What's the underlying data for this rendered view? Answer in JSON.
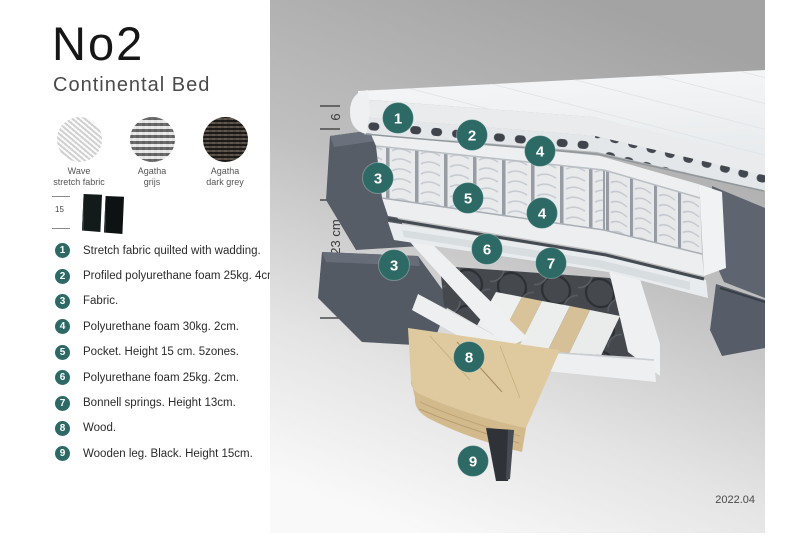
{
  "header": {
    "title": "No2",
    "subtitle": "Continental Bed"
  },
  "swatches": [
    {
      "line1": "Wave",
      "line2": "stretch fabric"
    },
    {
      "line1": "Agatha",
      "line2": "grijs"
    },
    {
      "line1": "Agatha",
      "line2": "dark grey"
    }
  ],
  "thumb": {
    "label": "15"
  },
  "legend": {
    "items": [
      {
        "num": "1",
        "text": "Stretch fabric quilted with wadding."
      },
      {
        "num": "2",
        "text": "Profiled polyurethane foam 25kg. 4cm."
      },
      {
        "num": "3",
        "text": "Fabric."
      },
      {
        "num": "4",
        "text": "Polyurethane foam 30kg. 2cm."
      },
      {
        "num": "5",
        "text": "Pocket. Height 15 cm. 5zones."
      },
      {
        "num": "6",
        "text": "Polyurethane foam 25kg. 2cm."
      },
      {
        "num": "7",
        "text": "Bonnell springs. Height 13cm."
      },
      {
        "num": "8",
        "text": "Wood."
      },
      {
        "num": "9",
        "text": "Wooden leg. Black. Height 15cm."
      }
    ]
  },
  "diagram": {
    "ruler": {
      "labels": [
        "6",
        "19 cm",
        "23 cm",
        "15 cm"
      ]
    },
    "markers": [
      {
        "n": "1"
      },
      {
        "n": "2"
      },
      {
        "n": "3"
      },
      {
        "n": "4"
      },
      {
        "n": "5"
      },
      {
        "n": "4"
      },
      {
        "n": "6"
      },
      {
        "n": "7"
      },
      {
        "n": "3"
      },
      {
        "n": "8"
      },
      {
        "n": "9"
      }
    ],
    "footer": "2022.04"
  },
  "ui_colors": {
    "accent_teal": "#2d6a66",
    "fabric_dark_grey": "#5b616c",
    "wood_tan": "#dcc89e",
    "mattress_white": "#eef0f2",
    "background_grey_top": "#a4a4a4"
  }
}
